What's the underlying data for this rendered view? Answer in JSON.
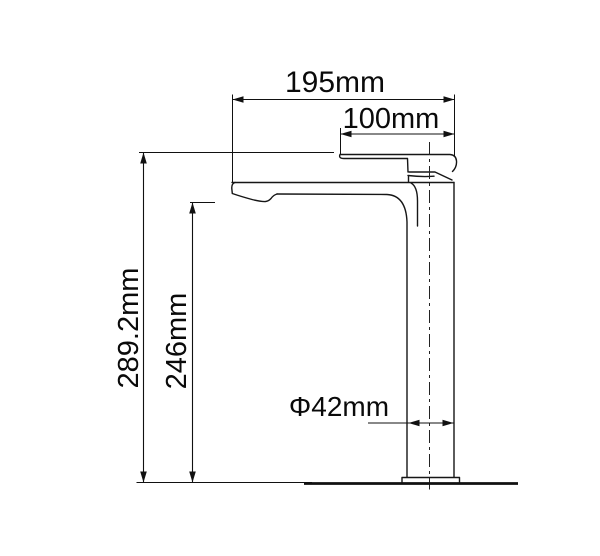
{
  "drawing": {
    "title": "tap-dimension-drawing",
    "unit": "mm",
    "background_color": "#ffffff",
    "line_color": "#111111",
    "dimensions": {
      "spout_reach": {
        "value": 195,
        "label": "195mm"
      },
      "top_reach": {
        "value": 100,
        "label": "100mm"
      },
      "overall_height": {
        "value": 289.2,
        "label": "289.2mm"
      },
      "spout_height": {
        "value": 246,
        "label": "246mm"
      },
      "body_diameter": {
        "value": 42,
        "label": "Φ42mm"
      }
    }
  }
}
